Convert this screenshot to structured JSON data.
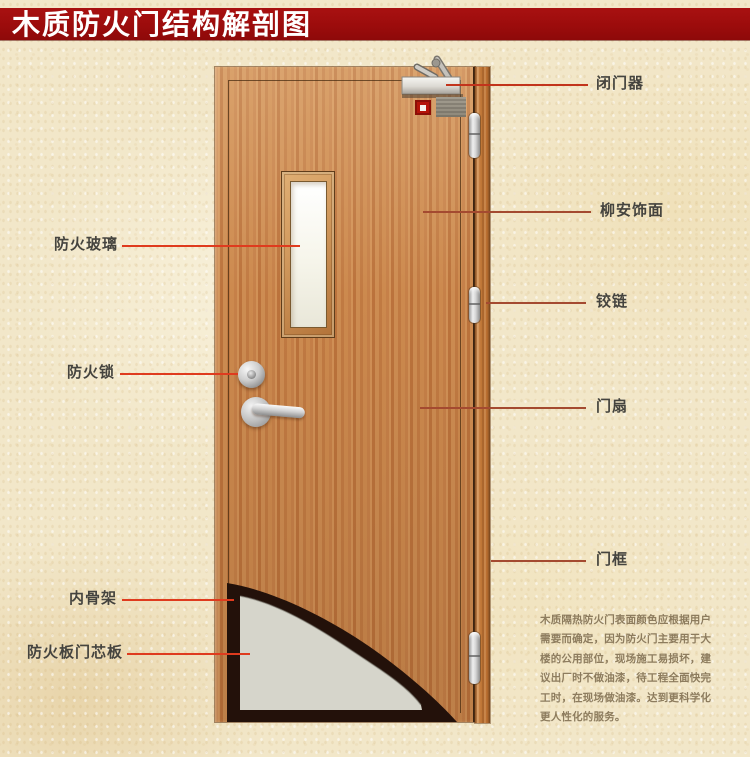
{
  "title": "木质防火门结构解剖图",
  "diagram": {
    "left_labels": [
      {
        "text": "防火玻璃"
      },
      {
        "text": "防火锁"
      },
      {
        "text": "内骨架"
      },
      {
        "text": "防火板门芯板"
      }
    ],
    "right_labels": [
      {
        "text": "闭门器"
      },
      {
        "text": "柳安饰面"
      },
      {
        "text": "铰链"
      },
      {
        "text": "门扇"
      },
      {
        "text": "门框"
      }
    ],
    "note_lines": [
      "木质隔热防火门表面颜色应根据用户",
      "需要而确定，因为防火门主要用于大",
      "楼的公用部位，现场施工易损坏，建",
      "议出厂时不做油漆，待工程全面快完",
      "工时，在现场做油漆。达到更科学化",
      "更人性化的服务。"
    ]
  },
  "colors": {
    "banner_red": "#9c0c0c",
    "leader_left": "#df3b1e",
    "leader_right": "#a44a30",
    "door_wood": "#c8824a",
    "core_board_gray": "#d6d5cb",
    "inner_skeleton_dark": "#23110a",
    "background_cream": "#f2e7c9"
  }
}
